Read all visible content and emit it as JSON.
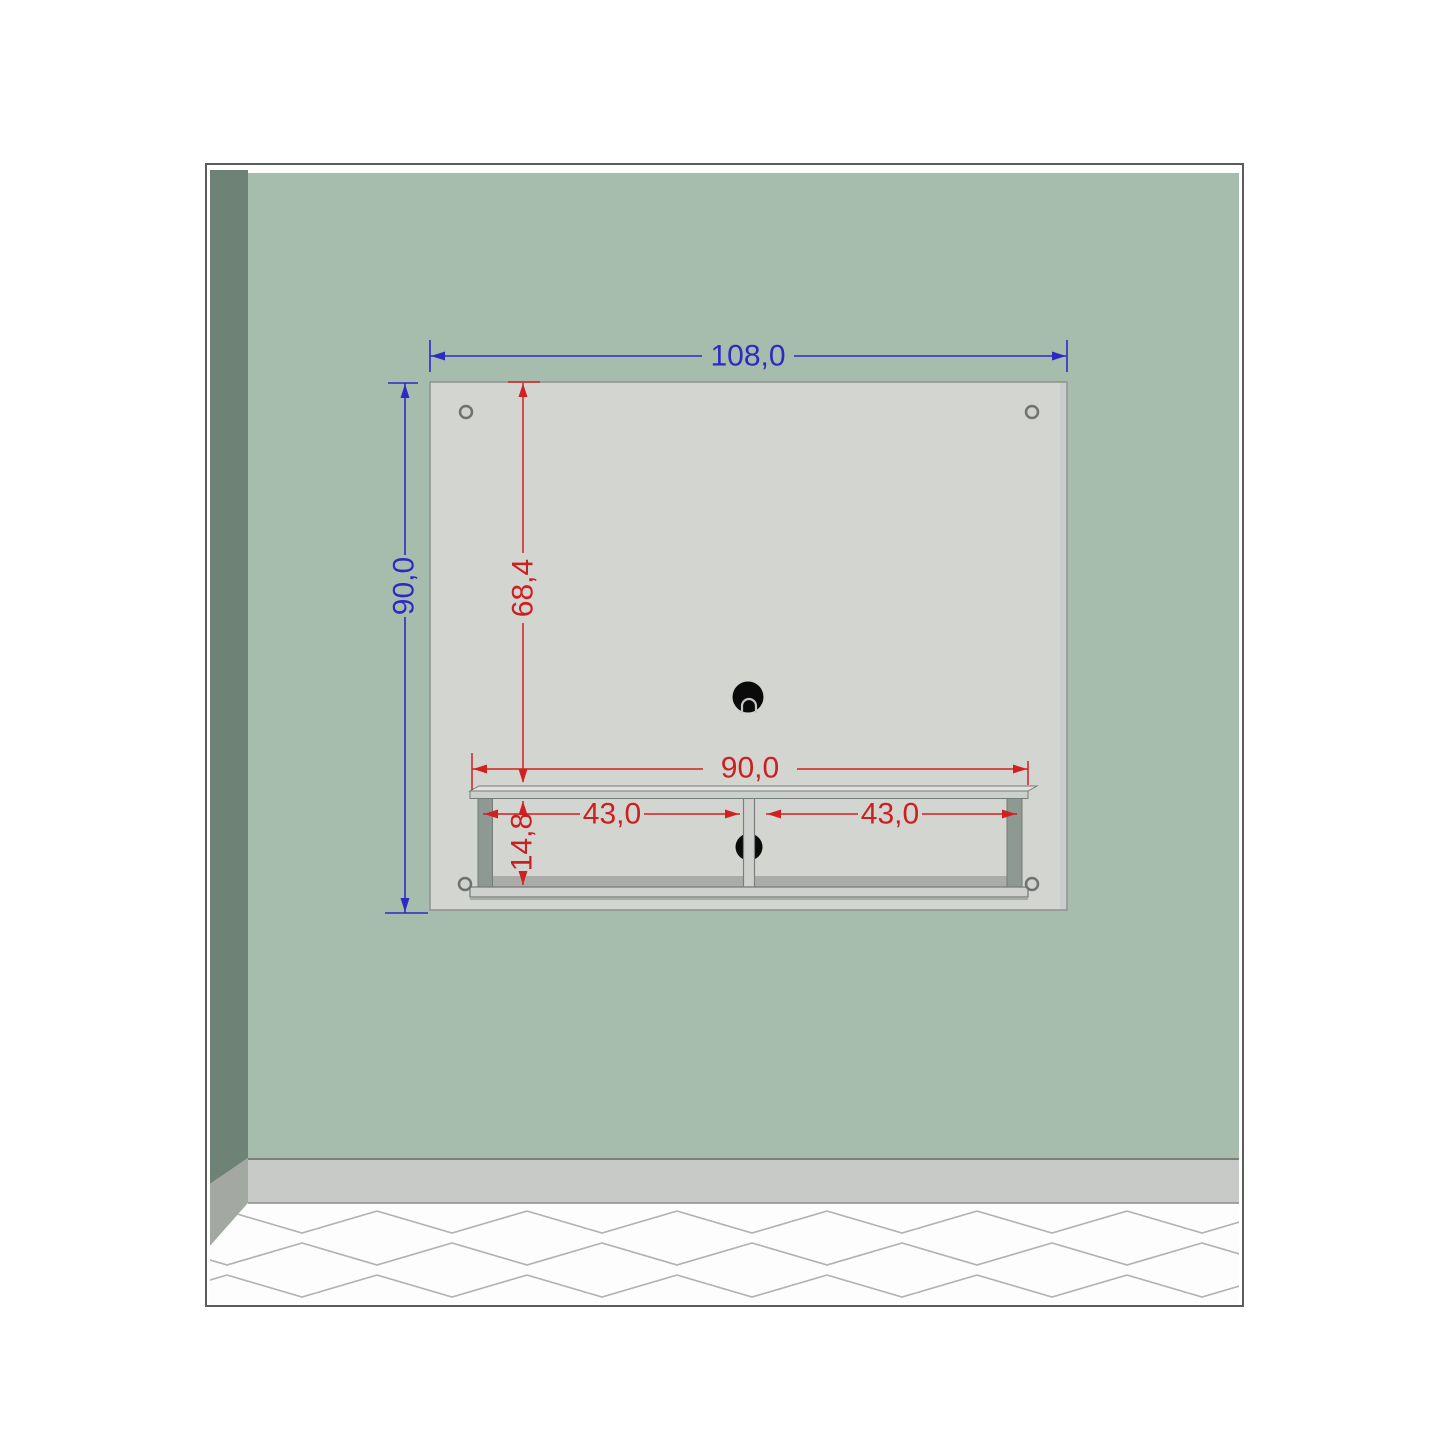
{
  "diagram": {
    "kind": "furniture-dimension-diagram",
    "subject": "wall-mounted tv panel with shelf"
  },
  "colors": {
    "frame": "#5a5e5a",
    "wall": "#a6bdad",
    "side_wall": "#6e8275",
    "baseboard": "#c7cac7",
    "side_baseboard": "#a3a8a3",
    "floor": "#fcfdfc",
    "floor_pattern": "#b2b2b2",
    "panel": "#d3d5d1",
    "shelf_side": "#8f9994",
    "shelf_board": "#ced1ce",
    "hole": "#0a0a0a",
    "dimension_blue": "#2b2bc4",
    "dimension_red": "#d12020"
  },
  "dimensions": {
    "panel_width": {
      "value": "108,0",
      "color": "blue",
      "orientation": "horizontal"
    },
    "panel_height": {
      "value": "90,0",
      "color": "blue",
      "orientation": "vertical"
    },
    "panel_top_to_shelf": {
      "value": "68,4",
      "color": "red",
      "orientation": "vertical"
    },
    "shelf_width": {
      "value": "90,0",
      "color": "red",
      "orientation": "horizontal"
    },
    "left_compartment_width": {
      "value": "43,0",
      "color": "red",
      "orientation": "horizontal"
    },
    "right_compartment_width": {
      "value": "43,0",
      "color": "red",
      "orientation": "horizontal"
    },
    "shelf_opening_height": {
      "value": "14,8",
      "color": "red",
      "orientation": "vertical"
    }
  }
}
